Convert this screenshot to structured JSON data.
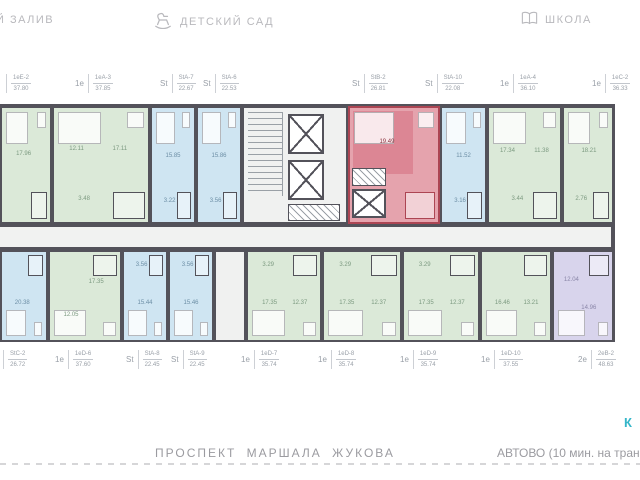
{
  "landmarks": {
    "bay": {
      "label": "Й ЗАЛИВ",
      "icon": "bay-icon"
    },
    "kindergarten": {
      "label": "ДЕТСКИЙ САД",
      "icon": "rocking-horse-icon"
    },
    "school": {
      "label": "ШКОЛА",
      "icon": "open-book-icon"
    }
  },
  "streets": {
    "avenue": "ПРОСПЕКТ МАРШАЛА ЖУКОВА",
    "metro": "АВТОВО (10 мин. на трансп",
    "map_label_fragment": "К"
  },
  "colors": {
    "wall": "#53525a",
    "corridor": "#f1f2f1",
    "label_text": "#9aa0a8",
    "landmark_text": "#b9b9bd",
    "street_text": "#9b9ba0",
    "teal": "#35b6c9",
    "selected_accent": "#ac4553",
    "unit_fills": {
      "green": {
        "bg": "#dbe9d8",
        "wall": "#53525a",
        "text": "#7c9a80"
      },
      "blue": {
        "bg": "#cfe5f2",
        "wall": "#53525a",
        "text": "#6d8fa6"
      },
      "purple": {
        "bg": "#d8d4ec",
        "wall": "#53525a",
        "text": "#8a86a8"
      },
      "red": {
        "bg": "#e5a3ad",
        "wall": "#ac4553",
        "text": "#8c3540"
      }
    }
  },
  "floor_plan": {
    "top_units": [
      {
        "type": "",
        "code": "1еЕ-2",
        "area": "37.80",
        "fill": "green",
        "x": 0,
        "w": 52,
        "label_x": 6,
        "rooms": [
          {
            "v": "17.96",
            "l": 45,
            "t": 40
          }
        ]
      },
      {
        "type": "1е",
        "code": "1еА-3",
        "area": "37.85",
        "fill": "green",
        "x": 52,
        "w": 98,
        "label_x": 75,
        "rooms": [
          {
            "v": "12.11",
            "l": 24,
            "t": 36
          },
          {
            "v": "17.11",
            "l": 70,
            "t": 36
          },
          {
            "v": "3.48",
            "l": 32,
            "t": 80
          }
        ]
      },
      {
        "type": "St",
        "code": "StА-7",
        "area": "22.67",
        "fill": "blue",
        "x": 150,
        "w": 46,
        "label_x": 160,
        "rooms": [
          {
            "v": "15.85",
            "l": 50,
            "t": 42
          },
          {
            "v": "3.22",
            "l": 42,
            "t": 82
          }
        ]
      },
      {
        "type": "St",
        "code": "StА-6",
        "area": "22.53",
        "fill": "blue",
        "x": 196,
        "w": 46,
        "label_x": 203,
        "rooms": [
          {
            "v": "15.86",
            "l": 50,
            "t": 42
          },
          {
            "v": "3.56",
            "l": 42,
            "t": 82
          }
        ]
      },
      {
        "type": "St",
        "code": "StВ-2",
        "area": "26.81",
        "fill": "red",
        "x": 348,
        "w": 92,
        "label_x": 352,
        "selected": true,
        "rooms": [
          {
            "v": "19.49",
            "l": 42,
            "t": 30
          }
        ]
      },
      {
        "type": "St",
        "code": "StА-10",
        "area": "22.08",
        "fill": "blue",
        "x": 440,
        "w": 47,
        "label_x": 425,
        "rooms": [
          {
            "v": "11.52",
            "l": 50,
            "t": 42
          },
          {
            "v": "3.16",
            "l": 42,
            "t": 82
          }
        ]
      },
      {
        "type": "1е",
        "code": "1еА-4",
        "area": "36.10",
        "fill": "green",
        "x": 487,
        "w": 75,
        "label_x": 500,
        "rooms": [
          {
            "v": "17.34",
            "l": 26,
            "t": 38
          },
          {
            "v": "11.38",
            "l": 74,
            "t": 38
          },
          {
            "v": "3.44",
            "l": 40,
            "t": 80
          }
        ]
      },
      {
        "type": "1е",
        "code": "1еС-2",
        "area": "36.33",
        "fill": "green",
        "x": 562,
        "w": 52,
        "label_x": 592,
        "rooms": [
          {
            "v": "18.21",
            "l": 52,
            "t": 38
          },
          {
            "v": "2.76",
            "l": 36,
            "t": 80
          }
        ]
      }
    ],
    "bottom_units": [
      {
        "type": "",
        "code": "StС-2",
        "area": "26.72",
        "fill": "blue",
        "x": 0,
        "w": 48,
        "label_x": 3,
        "rooms": [
          {
            "v": "20.38",
            "l": 46,
            "t": 58
          }
        ]
      },
      {
        "type": "1е",
        "code": "1еD-6",
        "area": "37.60",
        "fill": "green",
        "x": 48,
        "w": 74,
        "label_x": 55,
        "rooms": [
          {
            "v": "17.35",
            "l": 66,
            "t": 34
          },
          {
            "v": "12.05",
            "l": 30,
            "t": 72
          }
        ]
      },
      {
        "type": "St",
        "code": "StА-8",
        "area": "22.45",
        "fill": "blue",
        "x": 122,
        "w": 46,
        "label_x": 126,
        "rooms": [
          {
            "v": "15.44",
            "l": 50,
            "t": 58
          },
          {
            "v": "3.56",
            "l": 42,
            "t": 15
          }
        ]
      },
      {
        "type": "St",
        "code": "StА-9",
        "area": "22.45",
        "fill": "blue",
        "x": 168,
        "w": 46,
        "label_x": 171,
        "rooms": [
          {
            "v": "15.46",
            "l": 50,
            "t": 58
          },
          {
            "v": "3.56",
            "l": 42,
            "t": 15
          }
        ]
      },
      {
        "type": "1е",
        "code": "1еD-7",
        "area": "35.74",
        "fill": "green",
        "x": 246,
        "w": 76,
        "label_x": 241,
        "rooms": [
          {
            "v": "17.35",
            "l": 30,
            "t": 58
          },
          {
            "v": "12.37",
            "l": 72,
            "t": 58
          },
          {
            "v": "3.29",
            "l": 28,
            "t": 15
          }
        ]
      },
      {
        "type": "1е",
        "code": "1еD-8",
        "area": "35.74",
        "fill": "green",
        "x": 322,
        "w": 80,
        "label_x": 318,
        "rooms": [
          {
            "v": "17.35",
            "l": 30,
            "t": 58
          },
          {
            "v": "12.37",
            "l": 72,
            "t": 58
          },
          {
            "v": "3.29",
            "l": 28,
            "t": 15
          }
        ]
      },
      {
        "type": "1е",
        "code": "1еD-9",
        "area": "35.74",
        "fill": "green",
        "x": 402,
        "w": 78,
        "label_x": 400,
        "rooms": [
          {
            "v": "17.35",
            "l": 30,
            "t": 58
          },
          {
            "v": "12.37",
            "l": 72,
            "t": 58
          },
          {
            "v": "3.29",
            "l": 28,
            "t": 15
          }
        ]
      },
      {
        "type": "1е",
        "code": "1еD-10",
        "area": "37.55",
        "fill": "green",
        "x": 480,
        "w": 72,
        "label_x": 481,
        "rooms": [
          {
            "v": "16.46",
            "l": 30,
            "t": 58
          },
          {
            "v": "13.21",
            "l": 72,
            "t": 58
          }
        ]
      },
      {
        "type": "2е",
        "code": "2еВ-2",
        "area": "48.63",
        "fill": "purple",
        "x": 552,
        "w": 62,
        "label_x": 578,
        "rooms": [
          {
            "v": "12.04",
            "l": 30,
            "t": 32
          },
          {
            "v": "14.96",
            "l": 60,
            "t": 64
          }
        ]
      }
    ]
  }
}
